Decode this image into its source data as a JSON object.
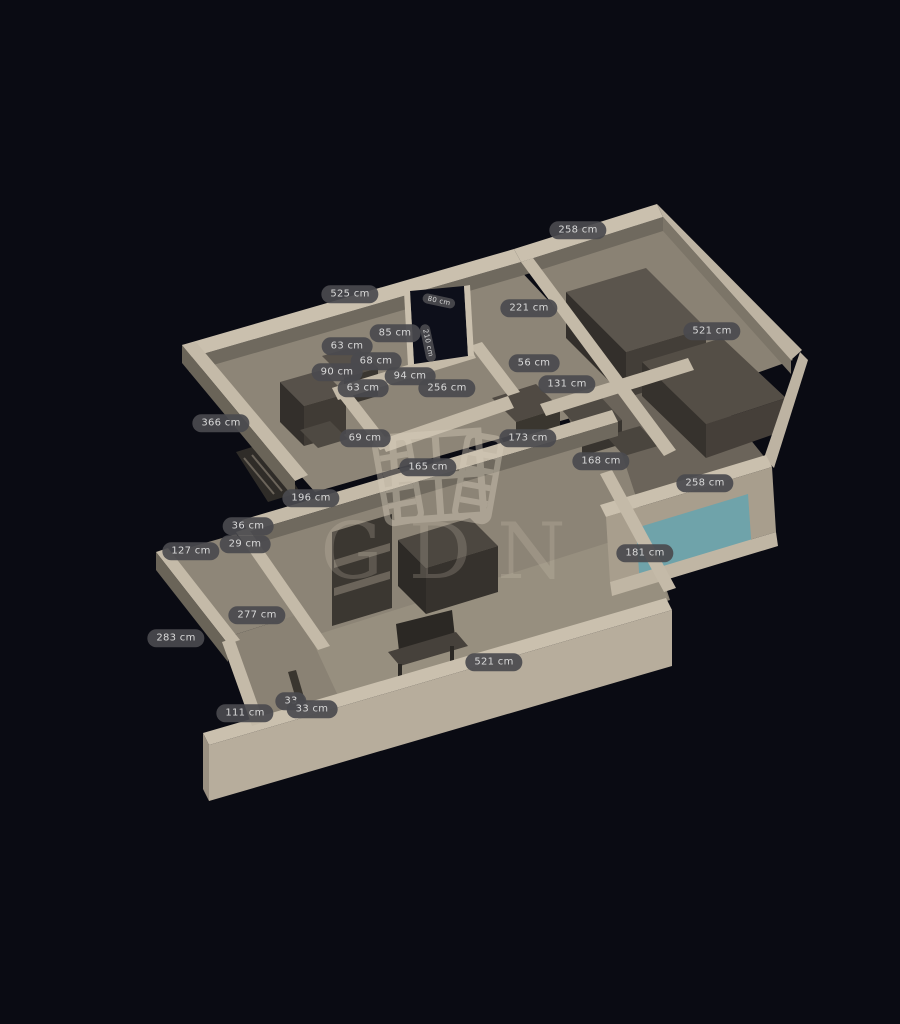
{
  "app": {
    "background_color": "#0a0b13",
    "view": "3d-floorplan"
  },
  "watermark": {
    "text": "GDN"
  },
  "palette": {
    "background": "#0a0b13",
    "wall_top": "#cac0ae",
    "wall_face_light": "#b7ad9c",
    "wall_face_dark": "#6f695e",
    "floor_light": "#978f7f",
    "floor_mid": "#8d8577",
    "floor_dark": "#6b645a",
    "furniture_top": "#57514a",
    "furniture_side": "#38342f",
    "window_glass": "#6fa3aa",
    "doorway": "#0d0f1a",
    "label_bg": "#4a4a4e",
    "label_text": "#d9d9d9"
  },
  "dimension_labels": [
    {
      "text": "258 cm",
      "x": 578,
      "y": 230
    },
    {
      "text": "525 cm",
      "x": 350,
      "y": 294
    },
    {
      "text": "221 cm",
      "x": 529,
      "y": 308
    },
    {
      "text": "80 cm",
      "x": 439,
      "y": 301,
      "rot": 12,
      "size": "small"
    },
    {
      "text": "210 cm",
      "x": 428,
      "y": 343,
      "rot": 78,
      "size": "small"
    },
    {
      "text": "85 cm",
      "x": 395,
      "y": 333
    },
    {
      "text": "63 cm",
      "x": 347,
      "y": 346
    },
    {
      "text": "68 cm",
      "x": 376,
      "y": 361
    },
    {
      "text": "90 cm",
      "x": 337,
      "y": 372
    },
    {
      "text": "63 cm",
      "x": 363,
      "y": 388
    },
    {
      "text": "94 cm",
      "x": 410,
      "y": 376
    },
    {
      "text": "256 cm",
      "x": 447,
      "y": 388
    },
    {
      "text": "56 cm",
      "x": 534,
      "y": 363
    },
    {
      "text": "131 cm",
      "x": 567,
      "y": 384
    },
    {
      "text": "521 cm",
      "x": 712,
      "y": 331
    },
    {
      "text": "366 cm",
      "x": 221,
      "y": 423
    },
    {
      "text": "69 cm",
      "x": 365,
      "y": 438
    },
    {
      "text": "173 cm",
      "x": 528,
      "y": 438
    },
    {
      "text": "165 cm",
      "x": 428,
      "y": 467
    },
    {
      "text": "168 cm",
      "x": 601,
      "y": 461
    },
    {
      "text": "258 cm",
      "x": 705,
      "y": 483
    },
    {
      "text": "196 cm",
      "x": 311,
      "y": 498
    },
    {
      "text": "36 cm",
      "x": 248,
      "y": 526
    },
    {
      "text": "29 cm",
      "x": 245,
      "y": 544
    },
    {
      "text": "127 cm",
      "x": 191,
      "y": 551
    },
    {
      "text": "181 cm",
      "x": 645,
      "y": 553
    },
    {
      "text": "277 cm",
      "x": 257,
      "y": 615
    },
    {
      "text": "283 cm",
      "x": 176,
      "y": 638
    },
    {
      "text": "521 cm",
      "x": 494,
      "y": 662
    },
    {
      "text": "33",
      "x": 291,
      "y": 701
    },
    {
      "text": "33 cm",
      "x": 312,
      "y": 709
    },
    {
      "text": "111 cm",
      "x": 245,
      "y": 713
    }
  ]
}
